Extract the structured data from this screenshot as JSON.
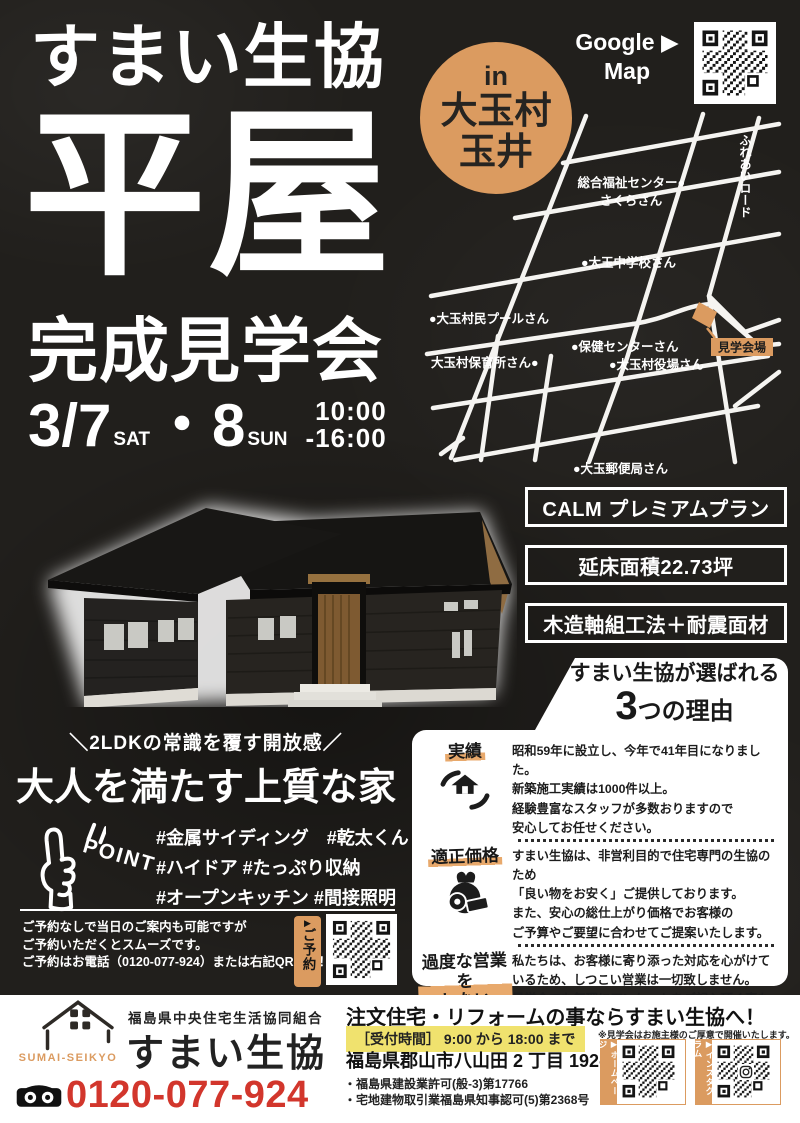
{
  "colors": {
    "orange": "#DB9B60",
    "red": "#D2362C",
    "yellow": "#F0E26E",
    "background": "#211F1C"
  },
  "header": {
    "brand": "すまい生協",
    "title": "平屋",
    "subtitle": "完成見学会",
    "date": {
      "day1": "3/7",
      "day1_label": "SAT",
      "day2": "・8",
      "day2_label": "SUN",
      "time_from": "10:00",
      "time_to": "-16:00"
    },
    "badge": {
      "prefix": "in",
      "line1": "大玉村",
      "line2": "玉井"
    },
    "google_map": {
      "line1": "Google ▶",
      "line2": "Map"
    }
  },
  "map": {
    "road_name": "ふれあいロード",
    "venue": "見学会場",
    "labels": {
      "fukushi": "総合福祉センター●",
      "sakura": "さくらさん",
      "school": "●大玉中学校さん",
      "pool": "●大玉村民プールさん",
      "hoken": "●保健センターさん",
      "hoiku": "大玉村保育所さん●",
      "yakuba": "●大玉村役場さん",
      "post": "●大玉郵便局さん"
    }
  },
  "specs": [
    "CALM プレミアムプラン",
    "延床面積22.73坪",
    "木造軸組工法＋耐震面材"
  ],
  "reasons": {
    "heading_line1": "すまい生協が選ばれる",
    "heading_number": "3",
    "heading_line2": "つの理由",
    "items": [
      {
        "label": "実績",
        "text": "昭和59年に設立し、今年で41年目になりました。\n新築施工実績は1000件以上。\n経験豊富なスタッフが多数おりますので\n安心してお任せください。"
      },
      {
        "label": "適正価格",
        "text": "すまい生協は、非営利目的で住宅専門の生協のため\n「良い物をお安く」ご提供しております。\nまた、安心の総仕上がり価格でお客様の\nご予算やご要望に合わせてご提案いたします。"
      },
      {
        "label": "過度な営業を\nしない",
        "text": "私たちは、お客様に寄り添った対応を心がけて\nいるため、しつこい営業は一切致しません。\n見学会でも無理にアンケートをご記入頂く事も\nしておりませんのでお気軽にお越しください。"
      }
    ]
  },
  "catch": {
    "eyebrow": "＼2LDKの常識を覆す開放感／",
    "main": "大人を満たす上質な家"
  },
  "point": {
    "label": "POINT",
    "tags1": "#金属サイディング　#乾太くん",
    "tags2": "#ハイドア #たっぷり収納",
    "tags3": "#オープンキッチン #間接照明"
  },
  "reserve": {
    "line1": "ご予約なしで当日のご案内も可能ですが",
    "line2": "ご予約いただくとスムーズです。",
    "line3": "ご予約はお電話（0120-077-924）または右記QRから！",
    "tag_arrow": "▶",
    "tag": "ご予約"
  },
  "footer": {
    "org": "福島県中央住宅生活協同組合",
    "name": "すまい生協",
    "logo_caption": "SUMAI-SEIKYO",
    "tel": "0120-077-924",
    "headline": "注文住宅・リフォームの事ならすまい生協へ！",
    "hours": "［受付時間］ 9:00 から 18:00 まで",
    "note": "※見学会はお施主様のご厚意で開催いたします。",
    "address": "福島県郡山市八山田 2 丁目 192-2",
    "license1": "・福島県建設業許可(般-3)第17766",
    "license2": "・宅地建物取引業福島県知事認可(5)第2368号",
    "qr_home_label": "▶ホームページ",
    "qr_insta_label": "▶インスタグラム"
  }
}
